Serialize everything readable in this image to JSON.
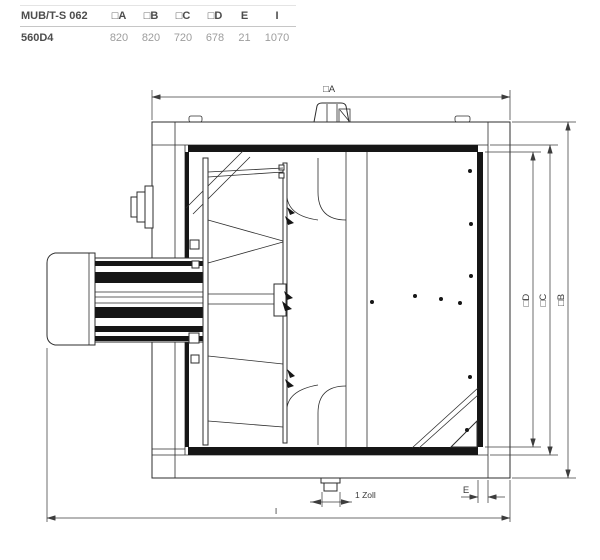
{
  "table": {
    "model_series": "MUB/T-S 062",
    "columns": [
      "□A",
      "□B",
      "□C",
      "□D",
      "E",
      "I"
    ],
    "row": {
      "model": "560D4",
      "values": [
        "820",
        "820",
        "720",
        "678",
        "21",
        "1070"
      ]
    }
  },
  "drawing": {
    "labels": {
      "dim_a": "□A",
      "dim_b": "□B",
      "dim_c": "□C",
      "dim_d": "□D",
      "dim_e": "E",
      "dim_i": "I",
      "drain": "1 Zoll"
    },
    "colors": {
      "line": "#2d2d2d",
      "dimension_line": "#3d3d3d",
      "panel_fill": "#161616",
      "table_header_text": "#4d4d4d",
      "table_value_text": "#9d9d9d"
    }
  }
}
